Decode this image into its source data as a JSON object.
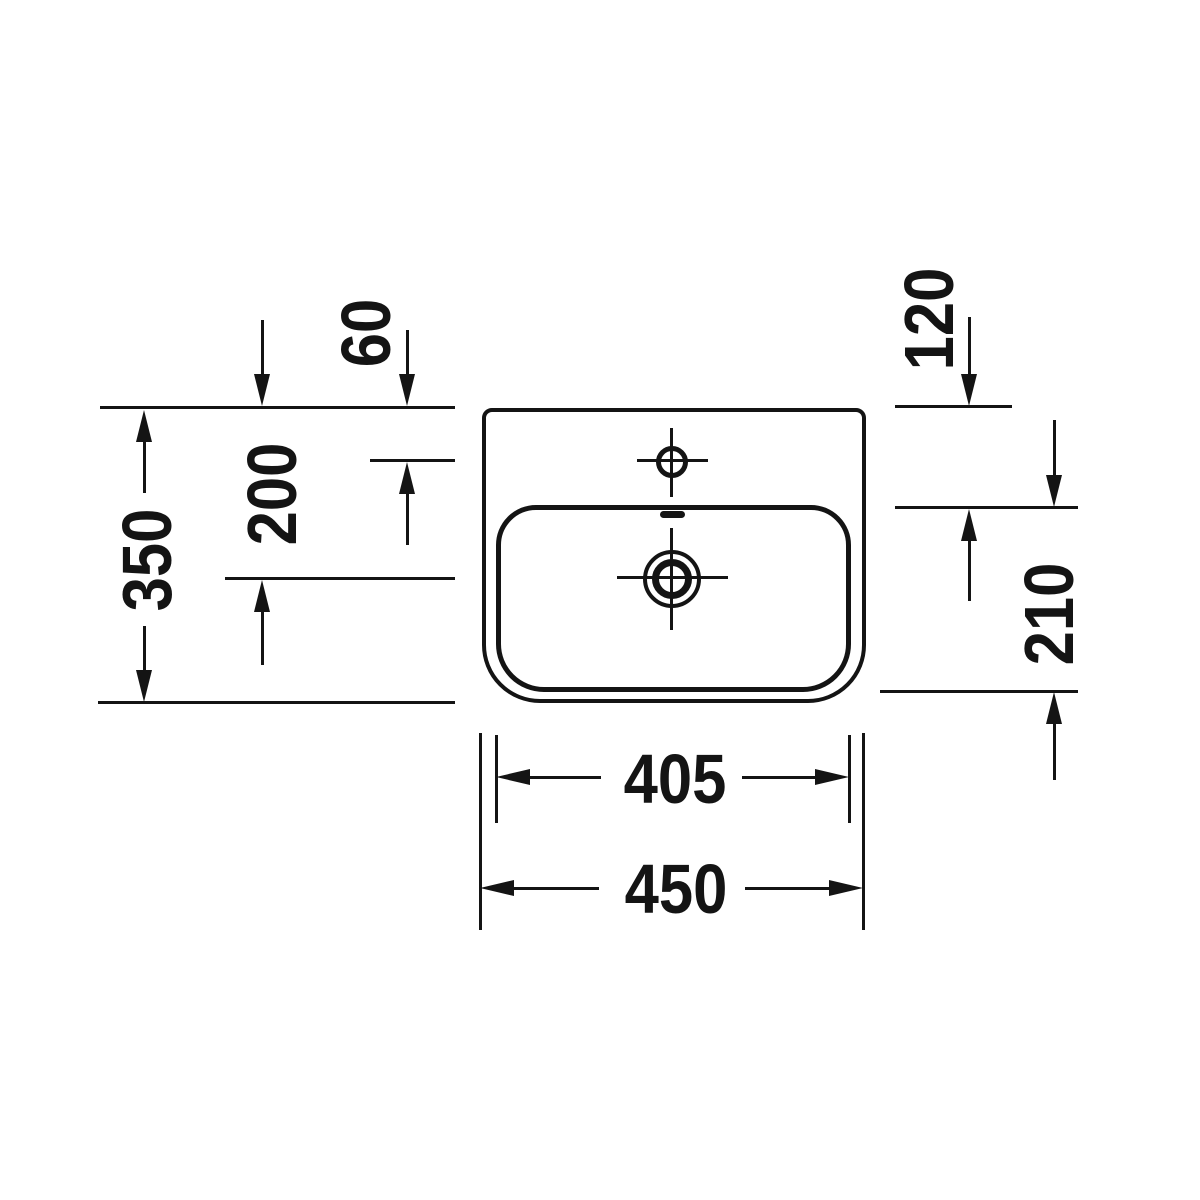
{
  "page": {
    "background": "#ffffff"
  },
  "drawing": {
    "kind": "washbasin-top-view-dimension-drawing",
    "line_color": "#141414",
    "labels": {
      "tap_hole_from_top": "60",
      "drain_center_from_top": "200",
      "depth_overall": "350",
      "basin_top_from_top": "120",
      "basin_depth": "210",
      "basin_width": "405",
      "width_overall": "450"
    }
  }
}
